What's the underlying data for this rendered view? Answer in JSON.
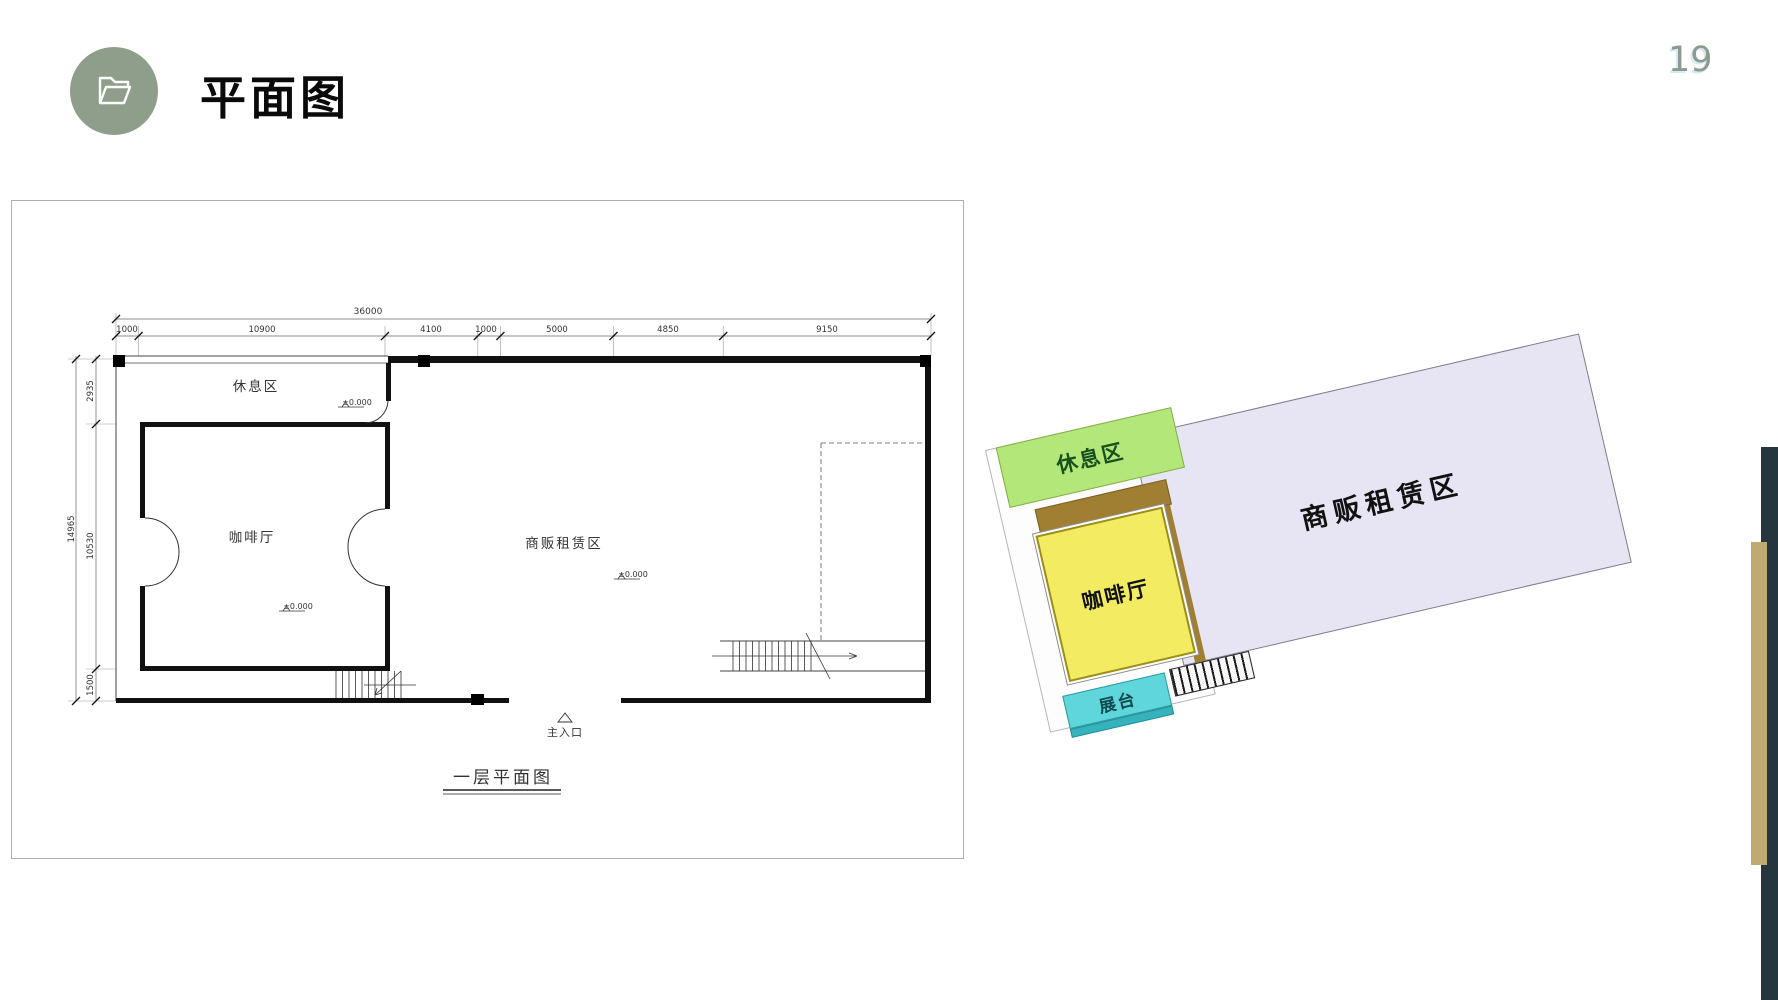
{
  "page": {
    "number": "19"
  },
  "header": {
    "title": "平面图"
  },
  "floor_plan": {
    "caption": "一层平面图",
    "entrance_label": "主入口",
    "rooms": [
      {
        "name": "休息区",
        "elevation": "±0.000"
      },
      {
        "name": "咖啡厅",
        "elevation": "±0.000"
      },
      {
        "name": "商贩租赁区",
        "elevation": "±0.000"
      }
    ],
    "dimensions": {
      "total_width": "36000",
      "top_segments": [
        "1000",
        "10900",
        "4100",
        "1000",
        "5000",
        "4850",
        "9150"
      ],
      "total_height": "14965",
      "left_segments": [
        "2935",
        "10530",
        "1500"
      ]
    }
  },
  "render_3d": {
    "zones": [
      {
        "label": "休息区",
        "color": "#b3e77a"
      },
      {
        "label": "咖啡厅",
        "color": "#f3ec62"
      },
      {
        "label": "商贩租赁区",
        "color": "#e7e5f4"
      },
      {
        "label": "展台",
        "color": "#5ed6da"
      }
    ]
  },
  "decor": {
    "accent_circle": "#8e9e8a",
    "page_number_color": "#8c9b90",
    "dark_bar": "#25363f",
    "gold_bar": "#bfab71"
  }
}
